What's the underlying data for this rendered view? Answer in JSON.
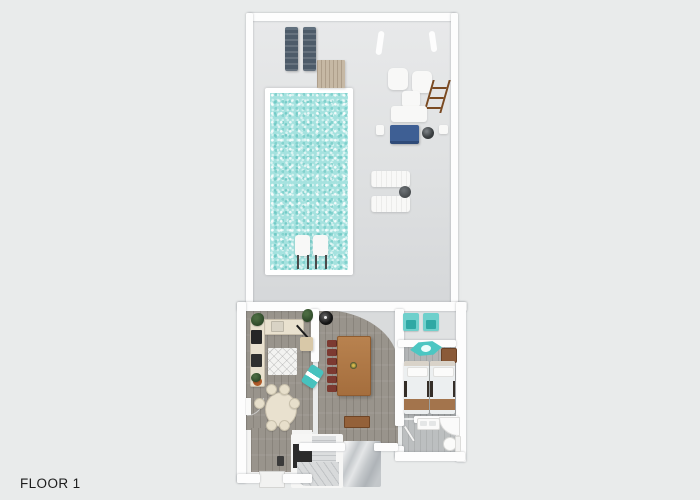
{
  "page": {
    "title": "3D floor plan render",
    "floor_label": "FLOOR 1"
  },
  "colors": {
    "background": "#e9ebeb",
    "yard_terrace": "#dfe1e2",
    "pool_water": "#a5e2df",
    "pool_coping": "#ffffff",
    "wall": "#fdfdfd",
    "interior_wood_floor": "#99948c",
    "bedroom_floor": "#b2b5b6",
    "bathroom_floor": "#bcbfc0",
    "marble_entry_floor": "#c3c7ca",
    "accent_teal": "#4cc6c2",
    "accent_navy": "#3e5f94",
    "lounger_slate": "#4d5b69",
    "dining_table_wood": "#a56e3d",
    "dining_chair_maroon": "#7c3a31",
    "cream_furniture": "#e9e1cf",
    "tan_mat": "#c6b8a4",
    "console_wood": "#94613a"
  },
  "areas": {
    "yard": "pool terrace",
    "pool": "swimming pool",
    "kitchen": "kitchen",
    "living_dining": "living and dining room",
    "breakfast_nook": "round table dining nook",
    "alcove": "covered patio alcove",
    "bedroom": "bedroom with two beds",
    "bathroom": "bathroom",
    "hallway": "hallway",
    "stairs": "winder staircase",
    "entry": "marble entry"
  },
  "objects": [
    "sun-lounger-slate x2",
    "wood deck mat",
    "white cube chair x2",
    "wood ladder shelf",
    "white side table",
    "white bench",
    "navy daybed",
    "round grill",
    "planter x2",
    "white pool lounger x2",
    "round side table",
    "in-pool ledge lounger x2",
    "kitchen counter L",
    "fridge",
    "oven",
    "sink",
    "patterned rug",
    "potted plant x3",
    "teal bar cart",
    "open door leaf",
    "oval table with six cream chairs",
    "long wood dining table",
    "maroon dining chair x6",
    "black round grill",
    "console table",
    "teal folding chair x2",
    "teal kayak",
    "wood dresser",
    "canopy single bed x2",
    "double sink vanity",
    "corner shower",
    "toilet",
    "front door step"
  ]
}
